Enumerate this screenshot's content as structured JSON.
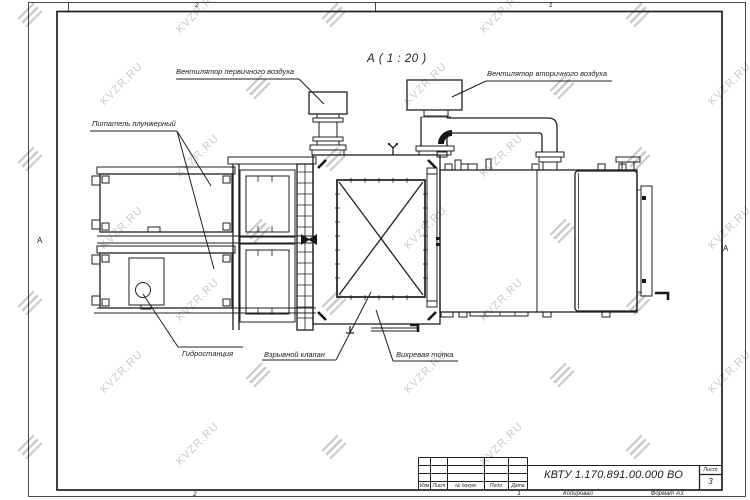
{
  "watermark": {
    "text": "KVZR.RU",
    "color": "#c7cacc"
  },
  "colors": {
    "ink": "#1f1f1f"
  },
  "view": {
    "title": "А ( 1 : 20 )"
  },
  "callouts": {
    "primary_fan": "Вентилятор первичного воздуха",
    "secondary_fan": "Вентилятор вторичного воздуха",
    "plunger_feeder": "Питатель плунжерный",
    "hydrostation": "Гидростанция",
    "explosion_valve": "Взрывной клапан",
    "vortex_furnace": "Вихревая топка"
  },
  "frame": {
    "zone_top_left": "2",
    "zone_top_right": "1",
    "zone_bottom": "2",
    "fold_mark_left": "А",
    "fold_mark_right": "А"
  },
  "title_block": {
    "doc_number": "КВТУ 1.170.891.00.000 ВО",
    "col_izm": "Изм",
    "col_list": "Лист",
    "col_doc": "№ докум.",
    "col_podp": "Подп.",
    "col_data": "Дата",
    "sheet_label": "Лист",
    "sheet_number": "3",
    "footer_num": "1",
    "footer_copied": "Копировал",
    "footer_format": "Формат А3"
  }
}
